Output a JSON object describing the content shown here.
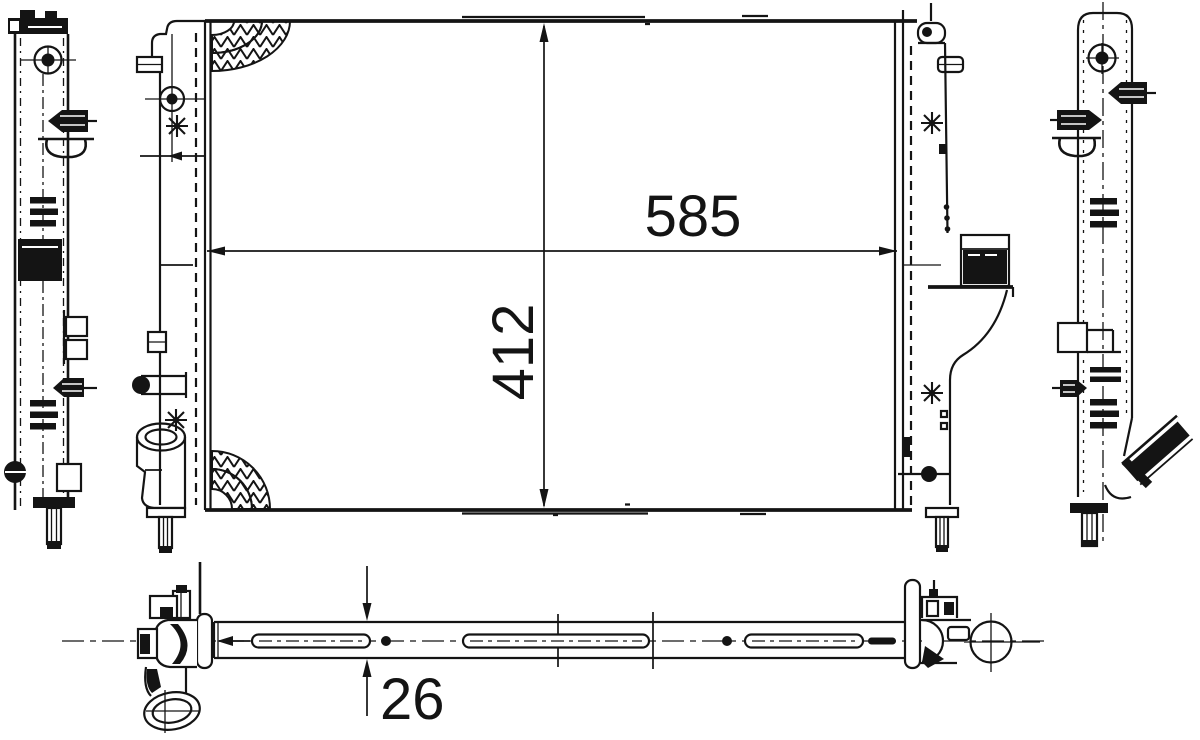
{
  "drawing": {
    "subject": "radiator technical drawing, four orthographic views",
    "style": "black line art on white"
  },
  "dimensions": {
    "core_width": "585",
    "core_height": "412",
    "core_depth": "26"
  },
  "colors": {
    "line": "#141414",
    "background": "#ffffff"
  }
}
